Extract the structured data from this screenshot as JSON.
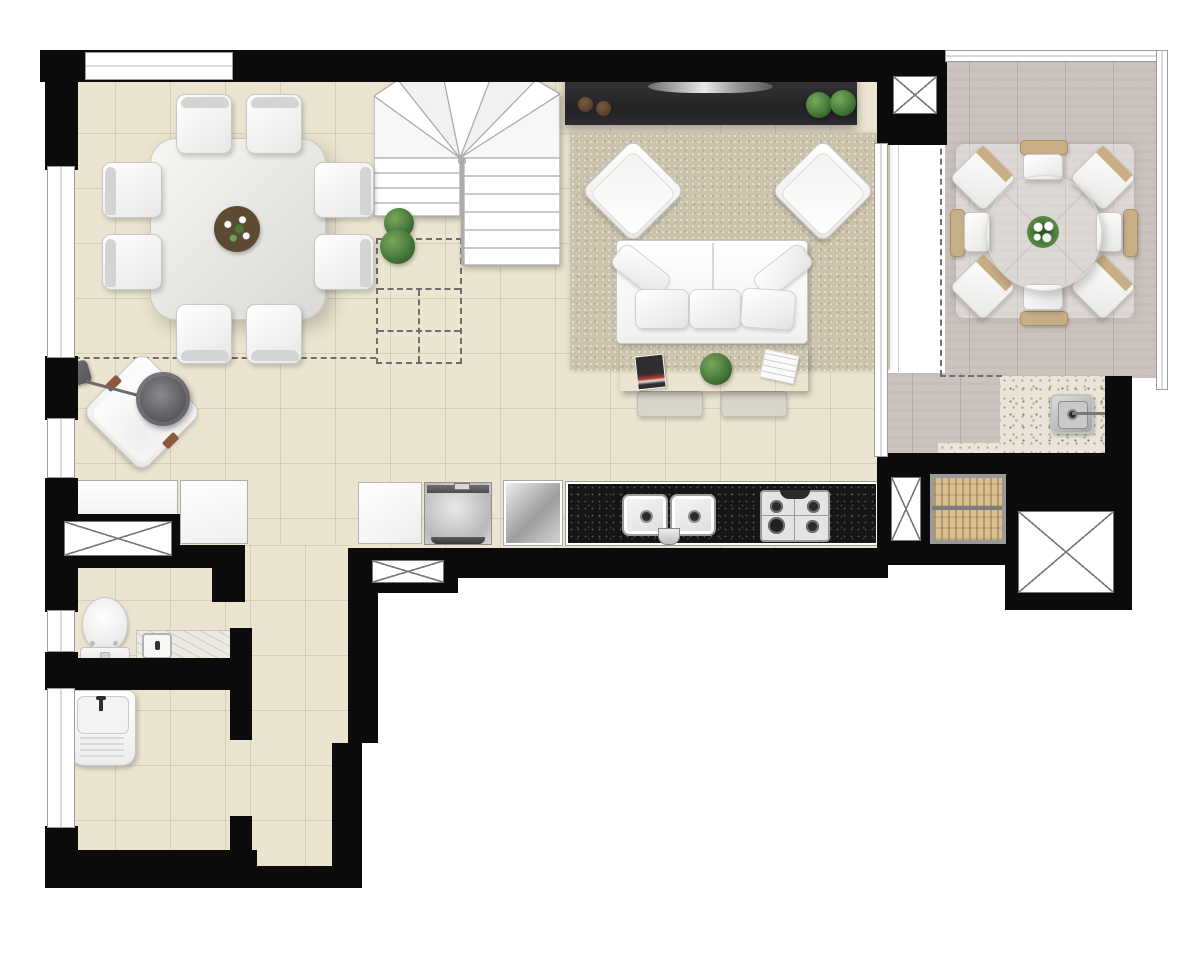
{
  "image_type": "architectural-floor-plan-render",
  "visible_text": [],
  "colors": {
    "background": "#ffffff",
    "wall": "#0b0b0b",
    "floor_tile": "#eae4d0",
    "terrace_plank": "#ccc3bf",
    "granite_counter_light": "#e9e5da",
    "granite_counter_black": "#151515",
    "rug": "#cbc3ac",
    "wood_table": "#ae8e6f",
    "plant_green": "#47793a",
    "wicker_tan": "#c8ae85",
    "appliance_steel": "#bfbfbf",
    "grill_grate": "#d9c18f",
    "skewer_handle": "#a96a30",
    "dash_line": "#6f6f6f"
  },
  "elements": {
    "rooms_pictured": [
      "dining-area",
      "stair-hall",
      "living-area",
      "kitchen",
      "terrace",
      "barbecue-corner",
      "bathroom",
      "laundry",
      "corridor"
    ],
    "furniture": [
      "dining-table-8-chairs",
      "winder-staircase",
      "lounge-chair",
      "floor-lamp",
      "tv-console",
      "tv",
      "area-rug",
      "armchair",
      "sofa",
      "sofa-table",
      "pouf",
      "kitchen-cabinet",
      "oven",
      "refrigerator",
      "black-granite-counter",
      "double-sink",
      "gas-cooktop",
      "barbecue-grill",
      "skewers",
      "outdoor-granite-counter",
      "outdoor-sink",
      "round-outdoor-table",
      "outdoor-chairs",
      "parasol-shade",
      "toilet",
      "marble-vanity",
      "laundry-tub",
      "planter-shrubs",
      "duct-shaft-x",
      "vent-box-x",
      "window",
      "sliding-glass-door",
      "projection-dashed-lines"
    ]
  }
}
